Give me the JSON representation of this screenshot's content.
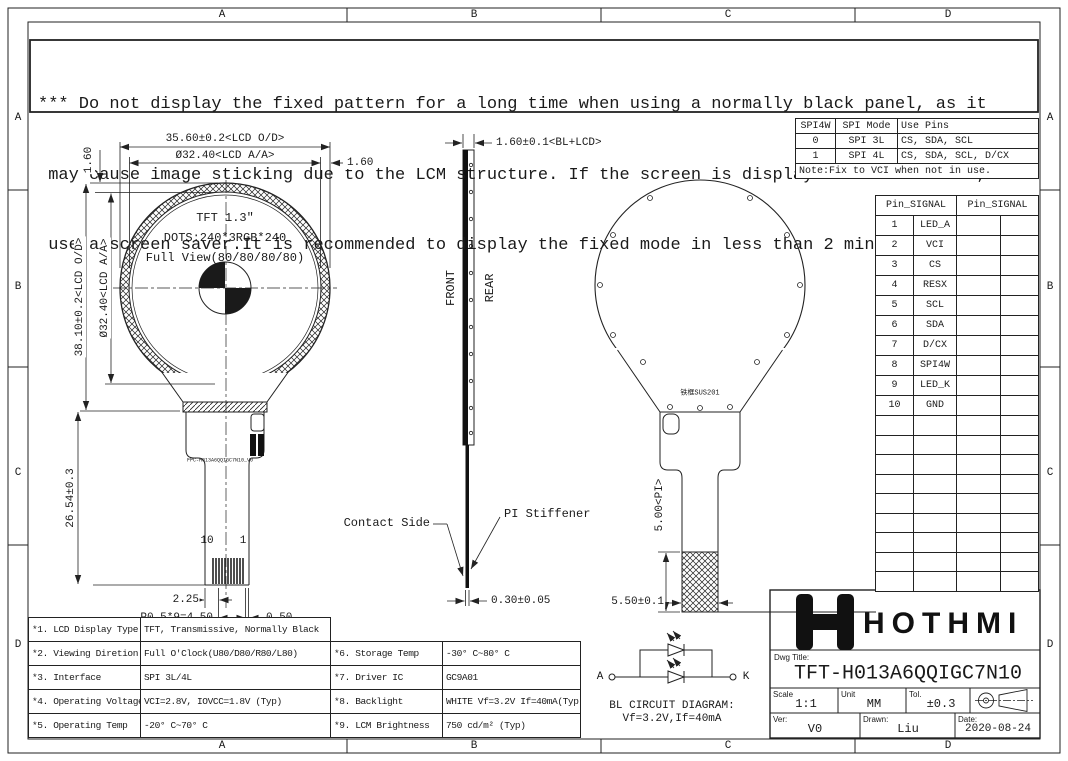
{
  "sheet": {
    "zone_columns": [
      "A",
      "B",
      "C",
      "D"
    ],
    "zone_rows": [
      "A",
      "B",
      "C",
      "D"
    ]
  },
  "warning": {
    "line1": "*** Do not display the fixed pattern for a long time when using a normally black panel, as it",
    "line2": " may cause image sticking due to the LCM structure. If the screen is displayed in fixed mode,",
    "line3": " use a screen saver.It is recommended to display the fixed mode in less than 2 minutes or less."
  },
  "front_view": {
    "panel_line1": "TFT 1.3″",
    "panel_line2": "DOTS:240*3RGB*240",
    "panel_line3": "Full View(80/80/80/80)",
    "dim_od_width": "35.60±0.2<LCD O/D>",
    "dim_aa_width": "Ø32.40<LCD A/A>",
    "dim_gap_right": "1.60",
    "dim_gap_left": "1.60",
    "dim_od_height": "38.10±0.2<LCD O/D>",
    "dim_aa_height": "Ø32.40<LCD A/A>",
    "dim_fpc_length": "26.54±0.3",
    "pin_last": "10",
    "pin_first": "1",
    "fpc_part_number": "FPC-H013A6QQIGC7N10_V0",
    "dim_tail_edge": "2.25",
    "dim_pitch": "P0.5*9=4.50",
    "dim_contact": "0.50"
  },
  "side_view": {
    "dim_thickness": "1.60±0.1<BL+LCD>",
    "front_label": "FRONT",
    "rear_label": "REAR",
    "contact_side_label": "Contact Side",
    "pi_stiffener_label": "PI Stiffener",
    "dim_fpc_thickness": "0.30±0.05"
  },
  "rear_view": {
    "frame_label": "铁框SUS201",
    "dim_pi_height": "5.00<PI>",
    "dim_tail_width": "5.50±0.1"
  },
  "spi_table": {
    "headers": [
      "SPI4W",
      "SPI Mode",
      "Use Pins"
    ],
    "rows": [
      {
        "spi4w": "0",
        "mode": "SPI 3L",
        "pins": "CS, SDA, SCL"
      },
      {
        "spi4w": "1",
        "mode": "SPI 4L",
        "pins": "CS, SDA, SCL, D/CX"
      }
    ],
    "note": "Note:Fix to VCI when not in use."
  },
  "pin_table": {
    "header_left": "Pin_SIGNAL",
    "header_right": "Pin_SIGNAL",
    "rows": [
      {
        "pin": "1",
        "signal": "LED_A"
      },
      {
        "pin": "2",
        "signal": "VCI"
      },
      {
        "pin": "3",
        "signal": "CS"
      },
      {
        "pin": "4",
        "signal": "RESX"
      },
      {
        "pin": "5",
        "signal": "SCL"
      },
      {
        "pin": "6",
        "signal": "SDA"
      },
      {
        "pin": "7",
        "signal": "D/CX"
      },
      {
        "pin": "8",
        "signal": "SPI4W"
      },
      {
        "pin": "9",
        "signal": "LED_K"
      },
      {
        "pin": "10",
        "signal": "GND"
      }
    ]
  },
  "spec_table": {
    "left_rows": [
      {
        "label": "*1. LCD Display Type",
        "value": "TFT, Transmissive, Normally Black"
      },
      {
        "label": "*2. Viewing Diretion",
        "value": "Full O'Clock(U80/D80/R80/L80)"
      },
      {
        "label": "*3. Interface",
        "value": "SPI 3L/4L"
      },
      {
        "label": "*4. Operating Voltage",
        "value": "VCI=2.8V, IOVCC=1.8V (Typ)"
      },
      {
        "label": "*5. Operating Temp",
        "value": "-20° C~70° C"
      }
    ],
    "right_rows": [
      {
        "label": "*6. Storage Temp",
        "value": "-30° C~80° C"
      },
      {
        "label": "*7. Driver IC",
        "value": "GC9A01"
      },
      {
        "label": "*8. Backlight",
        "value": "WHITE Vf=3.2V If=40mA(Typ)"
      },
      {
        "label": "*9. LCM Brightness",
        "value": "750 cd/m² (Typ)"
      }
    ]
  },
  "bl_circuit": {
    "terminal_a": "A",
    "terminal_k": "K",
    "caption_line1": "BL CIRCUIT DIAGRAM:",
    "caption_line2": "Vf=3.2V,If=40mA"
  },
  "title_block": {
    "brand": "HOTHMI",
    "dwg_title_label": "Dwg Title:",
    "dwg_title": "TFT-H013A6QQIGC7N10",
    "scale_label": "Scale",
    "scale": "1:1",
    "unit_label": "Unit",
    "unit": "MM",
    "tol_label": "Tol.",
    "tolerance": "±0.3",
    "ver_label": "Ver:",
    "version": "V0",
    "drawn_label": "Drawn:",
    "drawn_by": "Liu",
    "date_label": "Date:",
    "date": "2020-08-24"
  }
}
